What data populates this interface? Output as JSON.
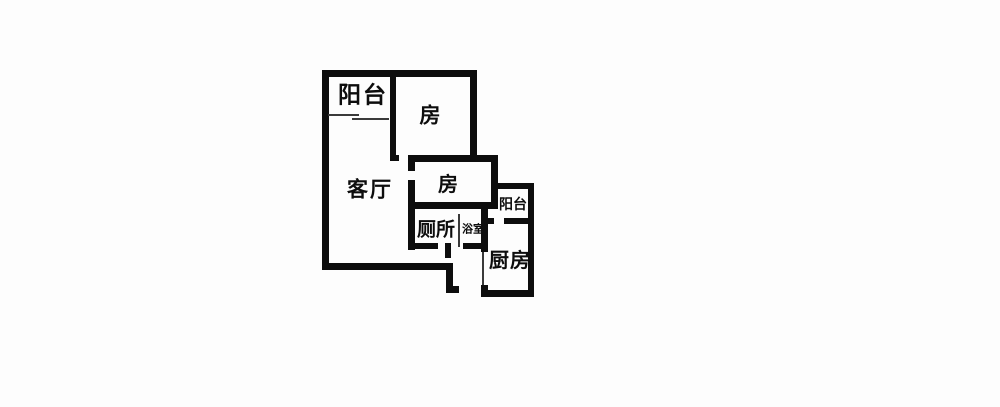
{
  "colors": {
    "wall": "#0d0d0d",
    "background": "#fdfdfd"
  },
  "floor_plan": {
    "type": "apartment-floor-plan",
    "rooms": [
      {
        "id": "balcony-top",
        "label": "阳台"
      },
      {
        "id": "bedroom-top",
        "label": "房"
      },
      {
        "id": "living-room",
        "label": "客厅"
      },
      {
        "id": "bedroom-middle",
        "label": "房"
      },
      {
        "id": "toilet",
        "label": "厕所"
      },
      {
        "id": "bathroom",
        "label": "浴室"
      },
      {
        "id": "balcony-right",
        "label": "阳台"
      },
      {
        "id": "kitchen",
        "label": "厨房"
      }
    ]
  }
}
